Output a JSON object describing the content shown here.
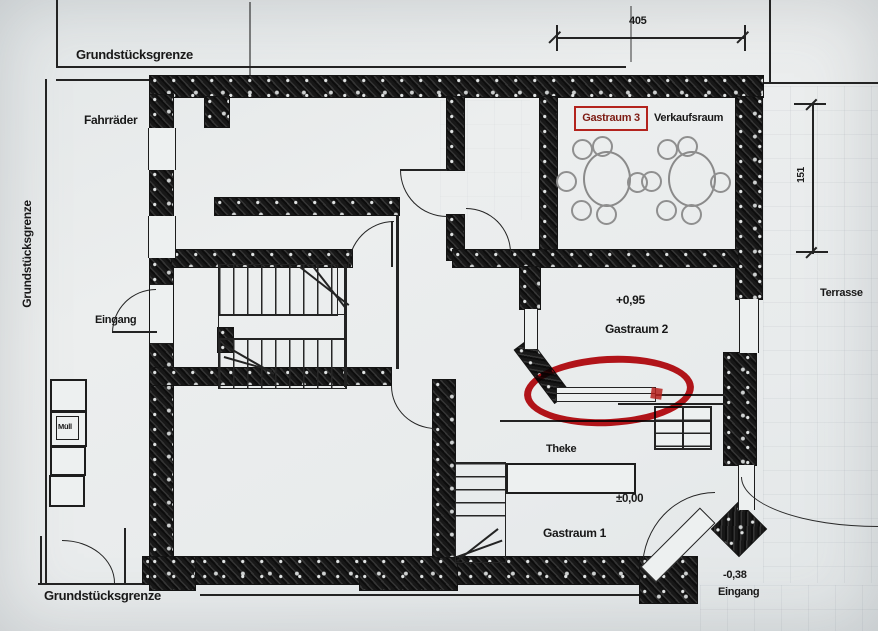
{
  "paper": {
    "background": "#e9ecec",
    "ink": "#1c1c1c"
  },
  "boundaries": {
    "top": "Grundstücksgrenze",
    "left": "Grundstücksgrenze",
    "bottom": "Grundstücksgrenze"
  },
  "dimensions": {
    "top_width": "405",
    "right_height": "151"
  },
  "labels": {
    "fahrraeder": "Fahrräder",
    "eingang_side": "Eingang",
    "muell": "Müll",
    "gastraum3": "Gastraum 3",
    "verkaufsraum": "Verkaufsraum",
    "gastraum2_level": "+0,95",
    "gastraum2": "Gastraum 2",
    "terrasse": "Terrasse",
    "theke": "Theke",
    "gastraum1_level": "±0,00",
    "gastraum1": "Gastraum 1",
    "entrance_level": "-0,38",
    "eingang_corner": "Eingang"
  },
  "annotation": {
    "shape": "red ellipse highlight",
    "color": "#c2151b",
    "box_color": "#b3231d"
  }
}
